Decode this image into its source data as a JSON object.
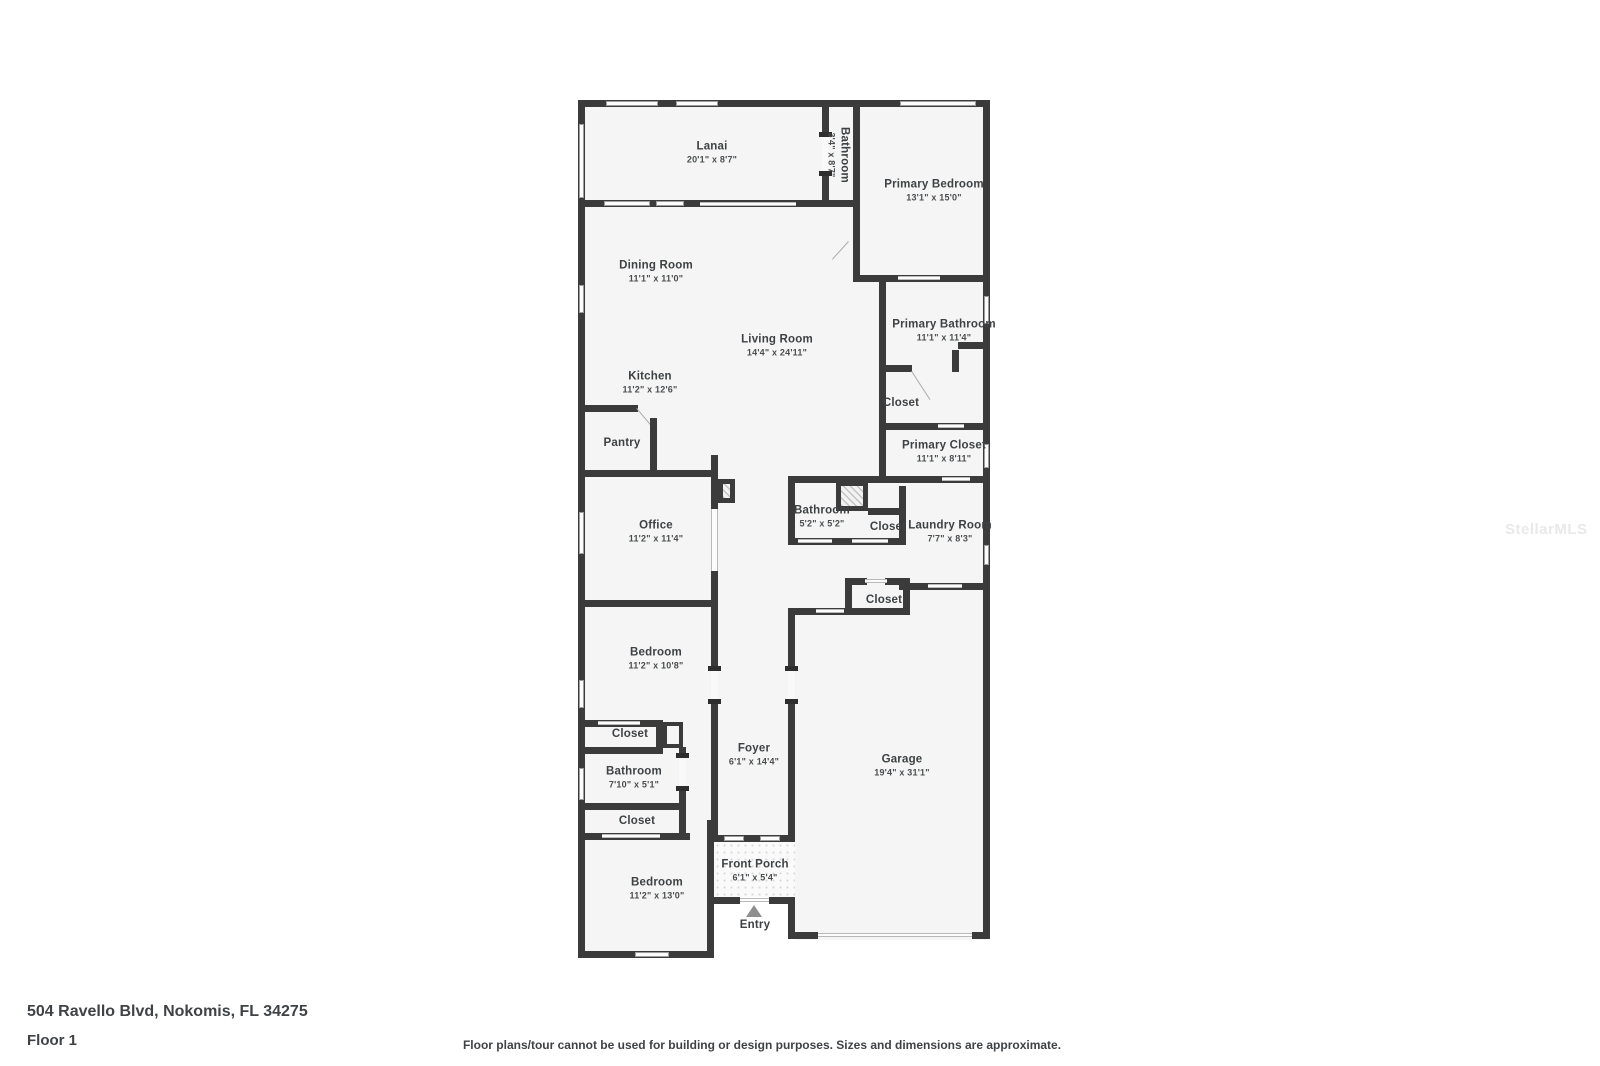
{
  "watermark": "StellarMLS",
  "footer": {
    "address": "504 Ravello Blvd, Nokomis, FL 34275",
    "floor": "Floor 1",
    "disclaimer": "Floor plans/tour cannot be used for building or design purposes. Sizes and dimensions are approximate."
  },
  "colors": {
    "wall": "#3b3b3b",
    "room_fill": "#f5f5f5",
    "label_text": "#3e4244",
    "watermark": "#e9e9e9",
    "entry_arrow": "#8f8f8f"
  },
  "rooms": [
    {
      "name": "Lanai",
      "dims": "20'1\" x 8'7\""
    },
    {
      "name": "Bathroom",
      "dims": "3'4\" x 8'7\""
    },
    {
      "name": "Primary Bedroom",
      "dims": "13'1\" x 15'0\""
    },
    {
      "name": "Dining Room",
      "dims": "11'1\" x 11'0\""
    },
    {
      "name": "Living Room",
      "dims": "14'4\" x 24'11\""
    },
    {
      "name": "Kitchen",
      "dims": "11'2\" x 12'6\""
    },
    {
      "name": "Pantry",
      "dims": ""
    },
    {
      "name": "Primary Bathroom",
      "dims": "11'1\" x 11'4\""
    },
    {
      "name": "Closet",
      "dims": ""
    },
    {
      "name": "Primary Closet",
      "dims": "11'1\" x 8'11\""
    },
    {
      "name": "Bathroom",
      "dims": "5'2\" x 5'2\""
    },
    {
      "name": "Closet",
      "dims": ""
    },
    {
      "name": "Laundry Room",
      "dims": "7'7\" x 8'3\""
    },
    {
      "name": "Closet",
      "dims": ""
    },
    {
      "name": "Office",
      "dims": "11'2\" x 11'4\""
    },
    {
      "name": "Bedroom",
      "dims": "11'2\" x 10'8\""
    },
    {
      "name": "Closet",
      "dims": ""
    },
    {
      "name": "Bathroom",
      "dims": "7'10\" x 5'1\""
    },
    {
      "name": "Closet",
      "dims": ""
    },
    {
      "name": "Bedroom",
      "dims": "11'2\" x 13'0\""
    },
    {
      "name": "Foyer",
      "dims": "6'1\" x 14'4\""
    },
    {
      "name": "Garage",
      "dims": "19'4\" x 31'1\""
    },
    {
      "name": "Front Porch",
      "dims": "6'1\" x 5'4\""
    },
    {
      "name": "Entry",
      "dims": ""
    }
  ]
}
